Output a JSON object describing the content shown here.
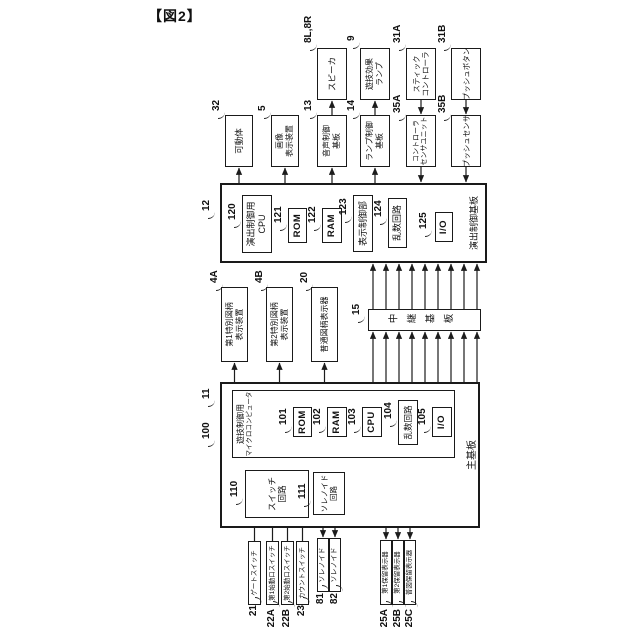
{
  "figure_title": "【図2】",
  "main_board": {
    "ref": "11",
    "name": "主基板",
    "micom": {
      "ref": "100",
      "lines": [
        "遊技制御用",
        "マイクロコンピュータ"
      ],
      "rom": {
        "ref": "101",
        "label": "ROM"
      },
      "ram": {
        "ref": "102",
        "label": "RAM"
      },
      "cpu": {
        "ref": "103",
        "label": "CPU"
      },
      "rand": {
        "ref": "104",
        "label": "乱数回路"
      },
      "io": {
        "ref": "105",
        "label": "I/O"
      }
    },
    "switch_circuit": {
      "ref": "110",
      "lines": [
        "スイッチ",
        "回路"
      ]
    },
    "solenoid_circuit": {
      "ref": "111",
      "lines": [
        "ソレノイド",
        "回路"
      ]
    }
  },
  "effect_board": {
    "ref": "12",
    "name": "演出制御基板",
    "cpu": {
      "ref": "120",
      "lines": [
        "演出制御用",
        "CPU"
      ]
    },
    "rom": {
      "ref": "121",
      "label": "ROM"
    },
    "ram": {
      "ref": "122",
      "label": "RAM"
    },
    "display_ctrl": {
      "ref": "123",
      "label": "表示制御部"
    },
    "rand": {
      "ref": "124",
      "label": "乱数回路"
    },
    "io": {
      "ref": "125",
      "label": "I/O"
    }
  },
  "relay_board": {
    "ref": "15",
    "name": "中継基板"
  },
  "symbol_displays": [
    {
      "ref": "4A",
      "lines": [
        "第1特別図柄",
        "表示装置"
      ]
    },
    {
      "ref": "4B",
      "lines": [
        "第2特別図柄",
        "表示装置"
      ]
    },
    {
      "ref": "20",
      "lines": [
        "普通図柄表示器"
      ]
    }
  ],
  "switches": [
    {
      "ref": "21",
      "label": "ゲートスイッチ"
    },
    {
      "ref": "22A",
      "label": "第1始動口スイッチ"
    },
    {
      "ref": "22B",
      "label": "第2始動口スイッチ"
    },
    {
      "ref": "23",
      "label": "カウントスイッチ"
    }
  ],
  "solenoids": [
    {
      "ref": "81",
      "label": "ソレノイド"
    },
    {
      "ref": "82",
      "label": "ソレノイド"
    }
  ],
  "hold_displays": [
    {
      "ref": "25A",
      "label": "第1保留表示器"
    },
    {
      "ref": "25B",
      "label": "第2保留表示器"
    },
    {
      "ref": "25C",
      "label": "普図保留表示器"
    }
  ],
  "devices": {
    "movable_body": {
      "ref": "32",
      "lines": [
        "可動体"
      ]
    },
    "image_display": {
      "ref": "5",
      "lines": [
        "画像",
        "表示装置"
      ]
    },
    "sound_board": {
      "ref": "13",
      "lines": [
        "音声制御",
        "基板"
      ]
    },
    "speaker": {
      "ref": "8L,8R",
      "lines": [
        "スピーカ"
      ]
    },
    "lamp_board": {
      "ref": "14",
      "lines": [
        "ランプ制御",
        "基板"
      ]
    },
    "effect_lamp": {
      "ref": "9",
      "lines": [
        "遊技効果",
        "ランプ"
      ]
    },
    "controller_sensor_unit": {
      "ref": "35A",
      "lines": [
        "コントローラ",
        "センサユニット"
      ]
    },
    "stick_controller": {
      "ref": "31A",
      "lines": [
        "スティック",
        "コントローラ"
      ]
    },
    "push_sensor": {
      "ref": "35B",
      "lines": [
        "プッシュセンサ"
      ]
    },
    "push_button": {
      "ref": "31B",
      "lines": [
        "プッシュボタン"
      ]
    }
  }
}
